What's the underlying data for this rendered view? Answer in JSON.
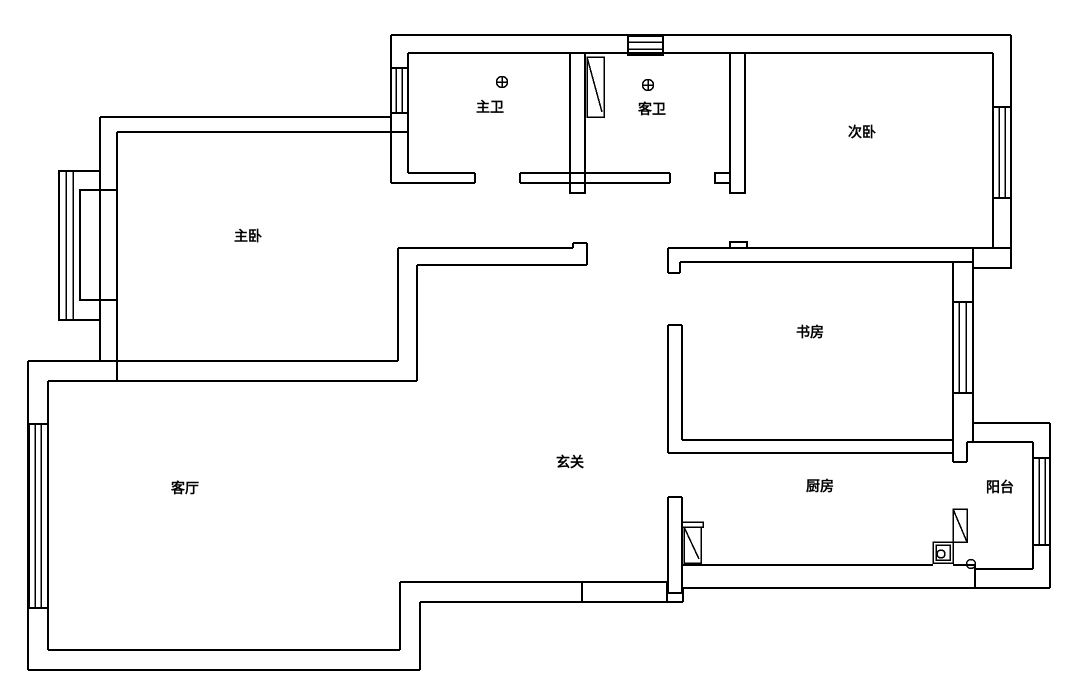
{
  "floorplan": {
    "canvas": {
      "width": 1070,
      "height": 698,
      "background": "#ffffff",
      "line_color": "#000000"
    },
    "room_labels": [
      {
        "id": "master-bedroom",
        "text": "主卧",
        "x": 248,
        "y": 237
      },
      {
        "id": "master-bathroom",
        "text": "主卫",
        "x": 490,
        "y": 108
      },
      {
        "id": "guest-bathroom",
        "text": "客卫",
        "x": 652,
        "y": 110
      },
      {
        "id": "second-bedroom",
        "text": "次卧",
        "x": 862,
        "y": 133
      },
      {
        "id": "study",
        "text": "书房",
        "x": 810,
        "y": 333
      },
      {
        "id": "living-room",
        "text": "客厅",
        "x": 185,
        "y": 489
      },
      {
        "id": "entry-hall",
        "text": "玄关",
        "x": 570,
        "y": 463
      },
      {
        "id": "kitchen",
        "text": "厨房",
        "x": 820,
        "y": 487
      },
      {
        "id": "balcony",
        "text": "阳台",
        "x": 1000,
        "y": 488
      }
    ],
    "wall_lines": [
      [
        391,
        35,
        1011,
        35
      ],
      [
        1011,
        35,
        1011,
        268
      ],
      [
        973,
        268,
        973,
        442
      ],
      [
        973,
        423,
        1050,
        423
      ],
      [
        1050,
        423,
        1050,
        588
      ],
      [
        1050,
        588,
        683,
        588
      ],
      [
        683,
        588,
        683,
        602
      ],
      [
        683,
        602,
        420,
        602
      ],
      [
        420,
        602,
        420,
        670
      ],
      [
        420,
        670,
        28,
        670
      ],
      [
        28,
        670,
        28,
        361
      ],
      [
        28,
        361,
        398,
        361
      ],
      [
        100,
        361,
        100,
        320
      ],
      [
        100,
        171,
        100,
        117
      ],
      [
        100,
        117,
        391,
        117
      ],
      [
        391,
        35,
        391,
        183
      ],
      [
        408,
        53,
        993,
        53
      ],
      [
        408,
        53,
        408,
        68
      ],
      [
        408,
        113,
        408,
        173
      ],
      [
        408,
        173,
        475,
        173
      ],
      [
        391,
        183,
        475,
        183
      ],
      [
        475,
        173,
        475,
        183
      ],
      [
        520,
        173,
        670,
        173
      ],
      [
        520,
        183,
        670,
        183
      ],
      [
        520,
        173,
        520,
        183
      ],
      [
        670,
        173,
        670,
        183
      ],
      [
        993,
        53,
        993,
        107
      ],
      [
        993,
        198,
        993,
        248
      ],
      [
        668,
        248,
        993,
        248
      ],
      [
        680,
        262,
        953,
        262
      ],
      [
        668,
        248,
        668,
        273
      ],
      [
        680,
        262,
        680,
        273
      ],
      [
        668,
        273,
        680,
        273
      ],
      [
        953,
        262,
        973,
        262
      ],
      [
        953,
        262,
        953,
        302
      ],
      [
        953,
        393,
        953,
        462
      ],
      [
        668,
        325,
        668,
        453
      ],
      [
        682,
        325,
        682,
        440
      ],
      [
        668,
        325,
        682,
        325
      ],
      [
        682,
        440,
        953,
        440
      ],
      [
        668,
        453,
        953,
        453
      ],
      [
        398,
        248,
        573,
        248
      ],
      [
        573,
        248,
        573,
        243
      ],
      [
        573,
        243,
        587,
        243
      ],
      [
        587,
        243,
        587,
        265
      ],
      [
        417,
        265,
        587,
        265
      ],
      [
        398,
        248,
        398,
        361
      ],
      [
        417,
        265,
        417,
        381
      ],
      [
        48,
        381,
        417,
        381
      ],
      [
        117,
        132,
        408,
        132
      ],
      [
        117,
        132,
        117,
        190
      ],
      [
        117,
        300,
        117,
        381
      ],
      [
        48,
        381,
        48,
        424
      ],
      [
        48,
        608,
        48,
        650
      ],
      [
        48,
        650,
        400,
        650
      ],
      [
        400,
        650,
        400,
        582
      ],
      [
        400,
        582,
        667,
        582
      ],
      [
        582,
        582,
        582,
        602
      ],
      [
        667,
        582,
        667,
        602
      ],
      [
        668,
        497,
        668,
        593
      ],
      [
        682,
        497,
        682,
        593
      ],
      [
        668,
        497,
        682,
        497
      ],
      [
        668,
        593,
        682,
        593
      ],
      [
        682,
        565,
        933,
        565
      ],
      [
        953,
        565,
        975,
        565
      ],
      [
        975,
        565,
        975,
        588
      ],
      [
        975,
        569,
        1033,
        569
      ],
      [
        1033,
        442,
        1033,
        458
      ],
      [
        1033,
        545,
        1033,
        569
      ],
      [
        967,
        442,
        1033,
        442
      ],
      [
        967,
        442,
        967,
        462
      ],
      [
        953,
        462,
        967,
        462
      ]
    ],
    "wall_rects": [
      [
        973,
        248,
        38,
        20
      ],
      [
        570,
        53,
        15,
        140
      ],
      [
        730,
        53,
        15,
        140
      ],
      [
        715,
        173,
        15,
        10
      ],
      [
        730,
        242,
        17,
        6
      ]
    ],
    "windows": [
      {
        "name": "bath-top-window",
        "rect": [
          628,
          36,
          35,
          19
        ],
        "mids": [
          [
            628,
            42,
            663,
            42
          ],
          [
            628,
            49,
            663,
            49
          ]
        ]
      },
      {
        "name": "master-bath-window",
        "rect": [
          391,
          68,
          17,
          45
        ],
        "mids": [
          [
            396,
            68,
            396,
            113
          ],
          [
            402,
            68,
            402,
            113
          ]
        ]
      },
      {
        "name": "second-bedroom-window",
        "rect": [
          993,
          107,
          18,
          91
        ],
        "mids": [
          [
            999,
            107,
            999,
            198
          ],
          [
            1005,
            107,
            1005,
            198
          ]
        ]
      },
      {
        "name": "study-window",
        "rect": [
          953,
          302,
          20,
          91
        ],
        "mids": [
          [
            959,
            302,
            959,
            393
          ],
          [
            966,
            302,
            966,
            393
          ]
        ]
      },
      {
        "name": "balcony-window",
        "rect": [
          1033,
          458,
          17,
          87
        ],
        "mids": [
          [
            1039,
            458,
            1039,
            545
          ],
          [
            1045,
            458,
            1045,
            545
          ]
        ]
      },
      {
        "name": "living-room-window",
        "rect": [
          29,
          424,
          19,
          184
        ],
        "mids": [
          [
            35,
            424,
            35,
            608
          ],
          [
            41,
            424,
            41,
            608
          ]
        ]
      },
      {
        "name": "bay-window-outer",
        "rect": [
          59,
          171,
          41,
          149
        ],
        "mids": [
          [
            66,
            171,
            66,
            320
          ],
          [
            73,
            171,
            73,
            320
          ]
        ]
      },
      {
        "name": "bay-window-sill",
        "rect": [
          80,
          190,
          37,
          110
        ],
        "mids": []
      }
    ],
    "door_leaves": [
      {
        "name": "guest-bath-door-leaf",
        "rect": [
          587,
          57,
          17,
          60
        ],
        "diag": [
          587,
          57,
          602,
          112
        ]
      },
      {
        "name": "kitchen-door-leaf",
        "rect": [
          684,
          527,
          17,
          36
        ],
        "diag": [
          684,
          527,
          699,
          559
        ],
        "frame": [
          682,
          522,
          21,
          5
        ]
      },
      {
        "name": "balcony-door-leaf",
        "rect": [
          953,
          509,
          14,
          33
        ],
        "diag": [
          953,
          509,
          967,
          542
        ]
      }
    ],
    "drains": [
      {
        "name": "master-bath-floor-drain",
        "x": 502,
        "y": 82,
        "r": 5.5
      },
      {
        "name": "guest-bath-floor-drain",
        "x": 648,
        "y": 85,
        "r": 5.5
      }
    ],
    "sink": {
      "outer": [
        933,
        542,
        20,
        21
      ],
      "inner": [
        936,
        545,
        14,
        15
      ],
      "circle": [
        941,
        554,
        4
      ]
    },
    "door_stop_circle": [
      971,
      564,
      4.5
    ]
  }
}
